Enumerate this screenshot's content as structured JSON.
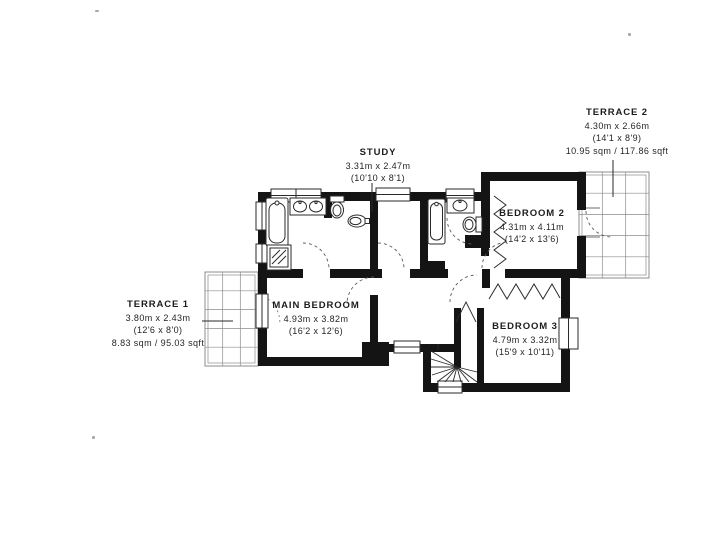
{
  "rooms": {
    "terrace2": {
      "name": "TERRACE 2",
      "dims_m": "4.30m x 2.66m",
      "dims_ft": "(14'1 x 8'9)",
      "area": "10.95 sqm / 117.86 sqft"
    },
    "study": {
      "name": "STUDY",
      "dims_m": "3.31m x 2.47m",
      "dims_ft": "(10'10 x 8'1)"
    },
    "bedroom2": {
      "name": "BEDROOM 2",
      "dims_m": "4.31m x 4.11m",
      "dims_ft": "(14'2 x 13'6)"
    },
    "terrace1": {
      "name": "TERRACE 1",
      "dims_m": "3.80m x 2.43m",
      "dims_ft": "(12'6 x 8'0)",
      "area": "8.83 sqm / 95.03 sqft"
    },
    "main_bedroom": {
      "name": "MAIN BEDROOM",
      "dims_m": "4.93m x 3.82m",
      "dims_ft": "(16'2 x 12'6)"
    },
    "bedroom3": {
      "name": "BEDROOM 3",
      "dims_m": "4.79m x 3.32m",
      "dims_ft": "(15'9 x 10'11)"
    }
  },
  "fixtures": [
    "bathtub",
    "shower",
    "double-sink",
    "toilet",
    "bidet",
    "bathtub",
    "sink",
    "toilet",
    "winder-staircase",
    "wardrobe",
    "wardrobe"
  ],
  "colors": {
    "wall": "#141414",
    "fixture_line": "#2a2a2a",
    "terrace_grid": "#8c8c8c",
    "leader_line": "#3a3a3a",
    "text": "#1c1c1c",
    "background": "#ffffff"
  }
}
